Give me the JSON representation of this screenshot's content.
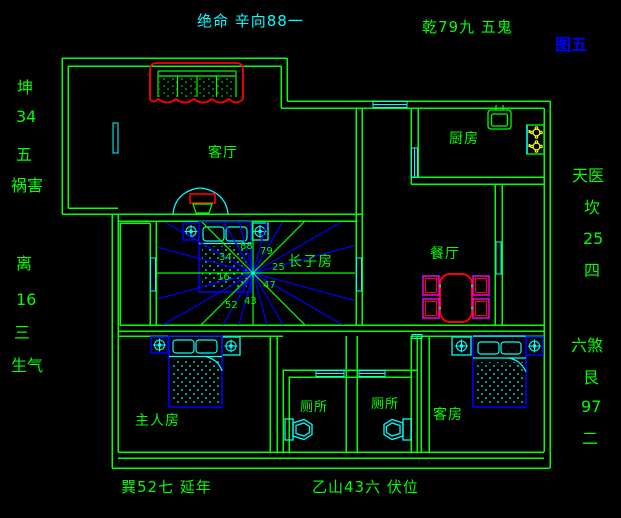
{
  "title": {
    "text": "图五",
    "color": "#0000ff"
  },
  "annotations": {
    "top_left": "绝命 辛向88一",
    "top_right": "乾79九 五鬼",
    "bottom_left": "巽52七 延年",
    "bottom_center": "乙山43六 伏位",
    "left_column": [
      "坤",
      "34",
      "五",
      "祸害",
      "离",
      "16",
      "三",
      "生气"
    ],
    "right_column": [
      "天医",
      "坎",
      "25",
      "四",
      "六煞",
      "艮",
      "97",
      "二"
    ]
  },
  "rooms": {
    "living_room": "客厅",
    "kitchen": "厨房",
    "eldest_son_room": "长子房",
    "dining_room": "餐厅",
    "master_bedroom": "主人房",
    "toilet_left": "厕所",
    "toilet_right": "厕所",
    "guest_room": "客房"
  },
  "compass_numbers": [
    "88",
    "79",
    "25",
    "47",
    "43",
    "52",
    "16",
    "34"
  ],
  "colors": {
    "background": "#000000",
    "wall_green": "#00ff00",
    "window_cyan": "#00ffff",
    "furniture_blue": "#0000ff",
    "accent_red": "#ff0000",
    "chair_magenta": "#ff00ff",
    "burner_yellow": "#ffff00",
    "title_blue": "#0000ff"
  }
}
